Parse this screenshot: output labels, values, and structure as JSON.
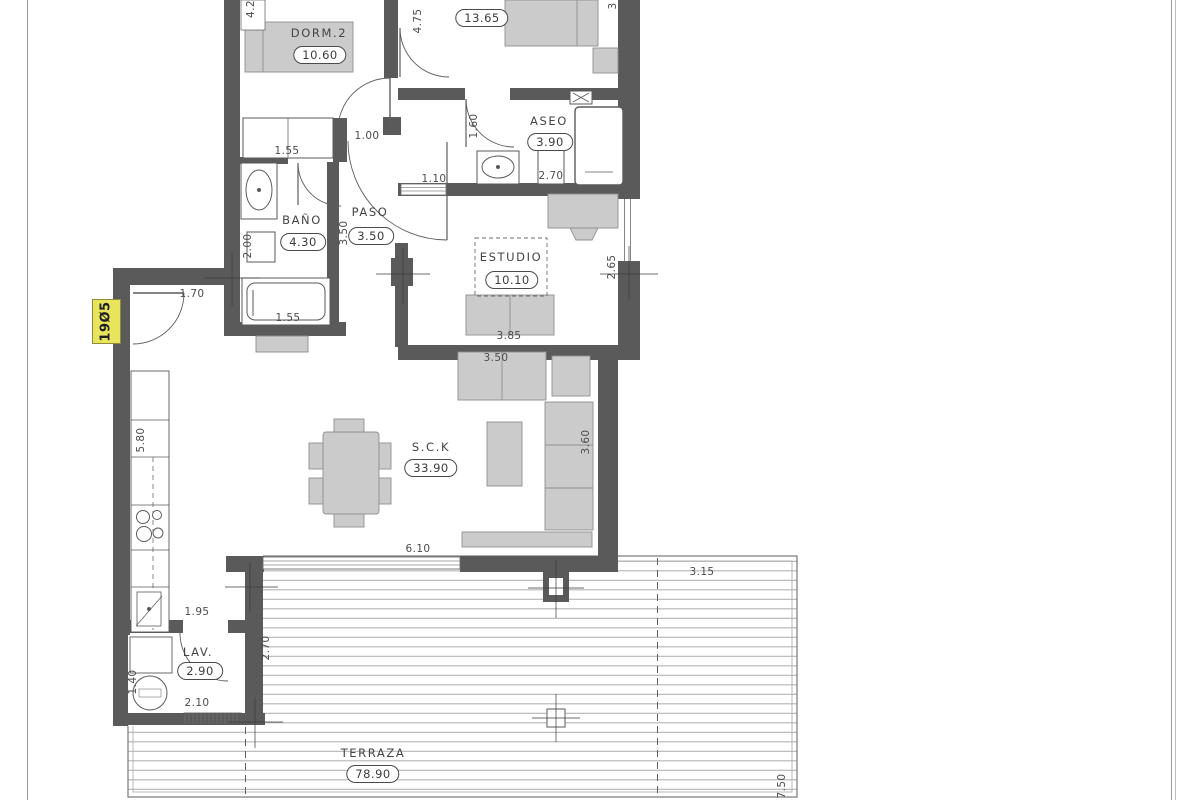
{
  "sheet": {
    "plate_label": "19Ø5"
  },
  "rooms": {
    "dorm2": {
      "name": "DORM.2",
      "area": "10.60"
    },
    "dorm1": {
      "name": "DORM.1",
      "area": "13.65"
    },
    "aseo": {
      "name": "ASEO",
      "area": "3.90"
    },
    "bano": {
      "name": "BAÑO",
      "area": "4.30"
    },
    "paso": {
      "name": "PASO",
      "area": "3.50"
    },
    "estudio": {
      "name": "ESTUDIO",
      "area": "10.10"
    },
    "sck": {
      "name": "S.C.K",
      "area": "33.90"
    },
    "lav": {
      "name": "LAV.",
      "area": "2.90"
    },
    "terraza": {
      "name": "TERRAZA",
      "area": "78.90"
    }
  },
  "dimensions": {
    "dorm2_top": "4.2",
    "dorm1_side": "4.75",
    "top_right_partial": "3",
    "wardrobe": "1.55",
    "dorm2_door": "1.00",
    "aseo_side": "1.60",
    "aseo_width": "2.70",
    "paso_pass": "1.10",
    "bano_side": "2.00",
    "paso_side": "3.50",
    "bath": "1.55",
    "entry_door": "1.70",
    "estudio_side": "2.65",
    "estudio_width": "3.85",
    "sofa_width": "3.50",
    "kitchen_run": "5.80",
    "sofa_side": "3.60",
    "sck_window": "6.10",
    "terraza_top": "3.15",
    "lav_pass": "1.95",
    "lav_side": "2.70",
    "lav_left": "1.40",
    "lav_width": "2.10",
    "terraza_side": "7.50"
  },
  "colors": {
    "wall": "#5a5a5a",
    "furniture": "#cbcbcb",
    "deck_line": "#b3b3b3",
    "plate_yellow": "#e9e45e"
  }
}
